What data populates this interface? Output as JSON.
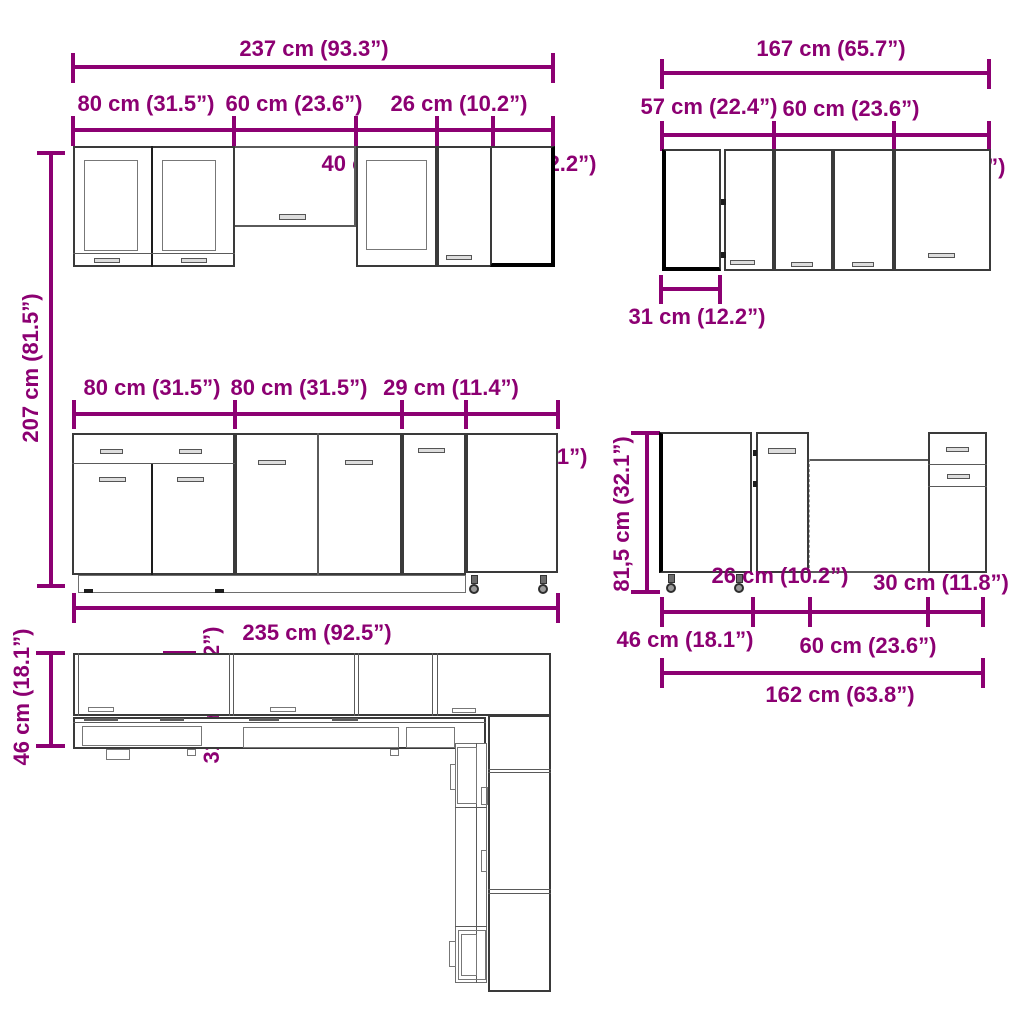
{
  "accent_color": "#8c0072",
  "line_color": "#3a3a3a",
  "sections": {
    "wall_run_left": {
      "total": "237 cm (93.3”)",
      "seg1": "80 cm (31.5”)",
      "seg2": "60 cm (23.6”)",
      "seg3": "26 cm (10.2”)",
      "inner1": "40 cm (15.7”)",
      "inner2": "31 cm (12.2”)",
      "height": "207 cm (81.5”)"
    },
    "wall_run_right": {
      "total": "167 cm (65.7”)",
      "seg1": "57 cm (22.4”)",
      "seg2": "60 cm (23.6”)",
      "inner1": "50 cm (19.7”)",
      "depth": "31 cm (12.2”)"
    },
    "base_run_left": {
      "seg1": "80 cm (31.5”)",
      "seg2": "80 cm (31.5”)",
      "seg3": "29 cm (11.4”)",
      "inner1": "46 cm (18.1”)",
      "total": "235 cm (92.5”)"
    },
    "base_run_right": {
      "height": "81,5 cm (32.1”)",
      "inner1": "26 cm (10.2”)",
      "inner2": "30 cm (11.8”)",
      "seg1": "46 cm (18.1”)",
      "seg2": "60 cm (23.6”)",
      "total": "162 cm (63.8”)"
    },
    "plan_view": {
      "depth_base": "46 cm (18.1”)",
      "depth_wall": "31 cm (12.2”)"
    }
  }
}
